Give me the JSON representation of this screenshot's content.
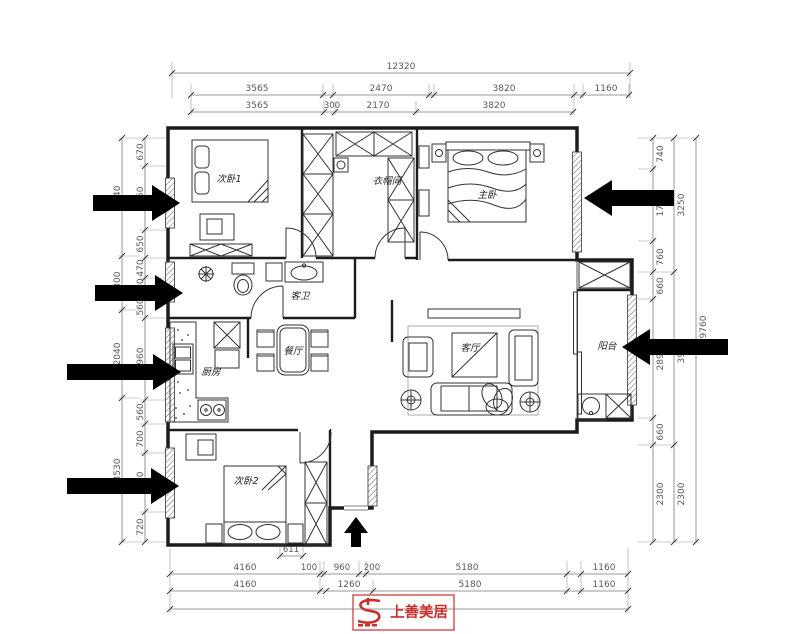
{
  "rooms": {
    "bedroom1": "次卧1",
    "cloakroom": "衣帽间",
    "master_bedroom": "主卧",
    "guest_bath": "客卫",
    "dining": "餐厅",
    "kitchen": "厨房",
    "living": "客厅",
    "balcony": "阳台",
    "bedroom2": "次卧2"
  },
  "dims": {
    "top_total": "12320",
    "top_row2": [
      "3565",
      "2470",
      "3820",
      "1160"
    ],
    "top_row3": [
      "3565",
      "300",
      "2170",
      "3820"
    ],
    "bottom_small": "611",
    "bottom_row1": [
      "4160",
      "100",
      "960",
      "200",
      "5180",
      "1160"
    ],
    "bottom_row2": [
      "4160",
      "1260",
      "5180",
      "1160"
    ],
    "left_outer": [
      "3040",
      "1300",
      "2040",
      "3530"
    ],
    "left_inner": [
      "670",
      "1550",
      "650",
      "470",
      "400",
      "560",
      "1960",
      "560",
      "700",
      "1500",
      "720"
    ],
    "right_inner": [
      "740",
      "1750",
      "760",
      "660",
      "2890",
      "660",
      "2300"
    ],
    "right_middle": [
      "3250",
      "3960",
      "2300"
    ],
    "right_total": "9760"
  },
  "logo": {
    "text": "上善美居"
  },
  "colors": {
    "wall": "#1c1c1c",
    "furniture": "#333333",
    "dim_line": "#7a7a7a",
    "dim_text": "#5a5a5a",
    "arrow": "#000000",
    "logo_red": "#c askedly"
  }
}
